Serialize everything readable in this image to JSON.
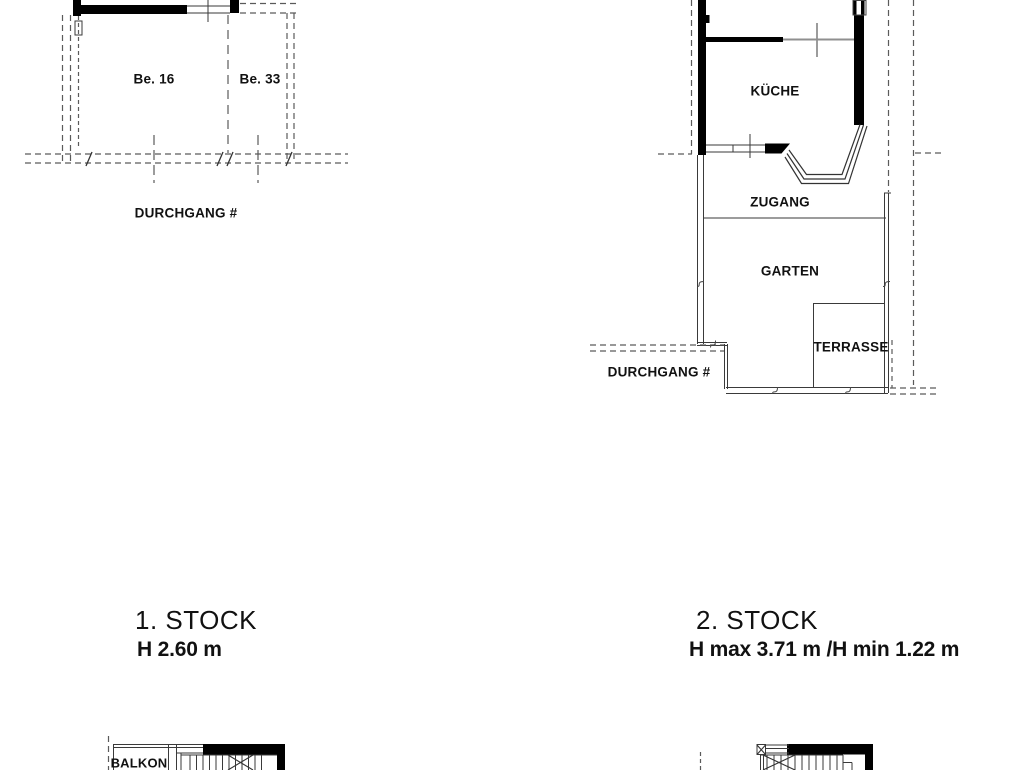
{
  "drawing": {
    "type": "architectural-floor-plan",
    "colors": {
      "background": "#ffffff",
      "wall_fill": "#000000",
      "thin_line": "#3a3a3a",
      "dashed_line": "#5a5a5a",
      "light_line": "#8f8f8f"
    },
    "plan_first_floor_top": {
      "room_left": "Be. 16",
      "room_right": "Be. 33",
      "passage": "DURCHGANG #"
    },
    "plan_second_floor_top": {
      "kitchen": "KÜCHE",
      "access": "ZUGANG",
      "garden": "GARTEN",
      "terrace": "TERRASSE",
      "passage": "DURCHGANG #"
    },
    "caption_first_floor": {
      "title": "1. STOCK",
      "height_note": "H 2.60 m"
    },
    "caption_second_floor": {
      "title": "2. STOCK",
      "height_note": "H max  3.71 m /H min 1.22 m"
    },
    "plan_first_floor_bottom": {
      "balcony": "BALKON"
    }
  }
}
